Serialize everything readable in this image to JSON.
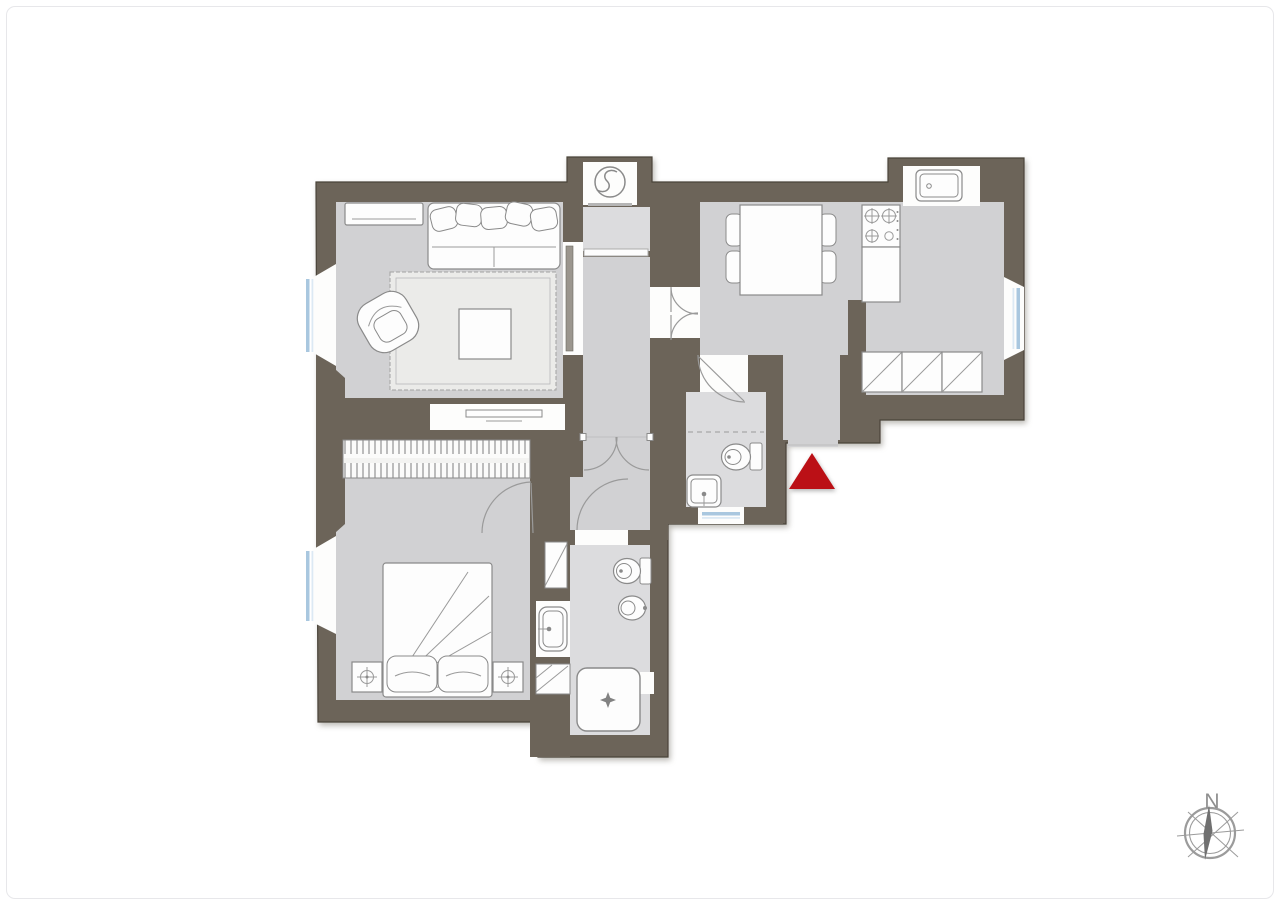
{
  "meta": {
    "kind": "architectural-floor-plan"
  },
  "colors": {
    "wall": "#6c6459",
    "wallOutline": "#4a443a",
    "floor": "#d1d1d3",
    "floorLight": "#dcdcde",
    "fixture": "#fdfdfd",
    "fixtureStroke": "#8a8a8a",
    "detail": "#9a9a9a",
    "rug": "#ebebe9",
    "glazing": "#a9c7df",
    "glazingLight": "#dce9f4",
    "entryMarker": "#bb1016",
    "compassStroke": "#9b9b9b",
    "needle": "#707070",
    "northText": "#8f8f8f",
    "frameBorder": "#e7e7ea",
    "doorPanel": "#9b968e"
  },
  "compass": {
    "north_label": "N"
  },
  "rooms": [
    {
      "id": "living-room",
      "fixtures": [
        "sofa",
        "armchair",
        "rug",
        "coffee-table",
        "console-table",
        "tv-cabinet",
        "window"
      ]
    },
    {
      "id": "bedroom",
      "fixtures": [
        "double-bed",
        "pillows",
        "nightstand-left",
        "nightstand-right",
        "wardrobe",
        "window"
      ]
    },
    {
      "id": "dining-kitchen",
      "fixtures": [
        "dining-table",
        "four-chairs",
        "stove-4-burners",
        "kitchen-sink",
        "counter",
        "base-cabinets",
        "window"
      ]
    },
    {
      "id": "bathroom",
      "fixtures": [
        "toilet",
        "bidet",
        "sink",
        "shower",
        "cabinets"
      ]
    },
    {
      "id": "wc",
      "fixtures": [
        "toilet",
        "sink",
        "window"
      ]
    },
    {
      "id": "hallway",
      "fixtures": [
        "double-door",
        "entry-opening"
      ]
    },
    {
      "id": "elevator",
      "fixtures": [
        "elevator-symbol"
      ]
    }
  ],
  "markers": {
    "entrance": "red-triangle",
    "compass": "compass-rose-north"
  }
}
